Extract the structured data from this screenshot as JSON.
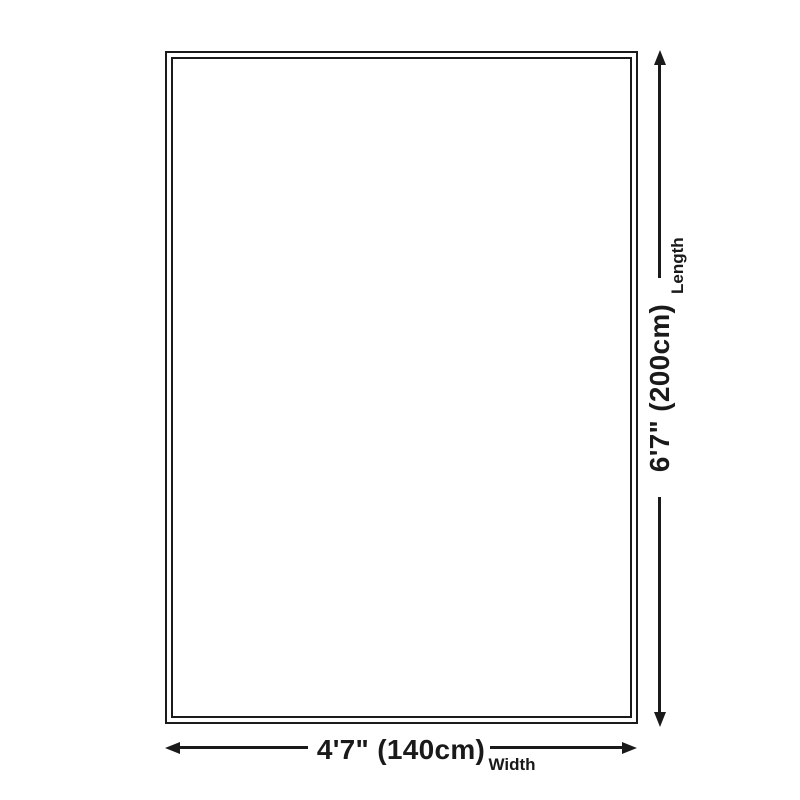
{
  "diagram": {
    "colors": {
      "background": "#ffffff",
      "line": "#1a1a1a",
      "text": "#1a1a1a"
    },
    "length": {
      "value": "6'7\" (200cm)",
      "label": "Length"
    },
    "width": {
      "value": "4'7\" (140cm)",
      "label": "Width"
    }
  }
}
